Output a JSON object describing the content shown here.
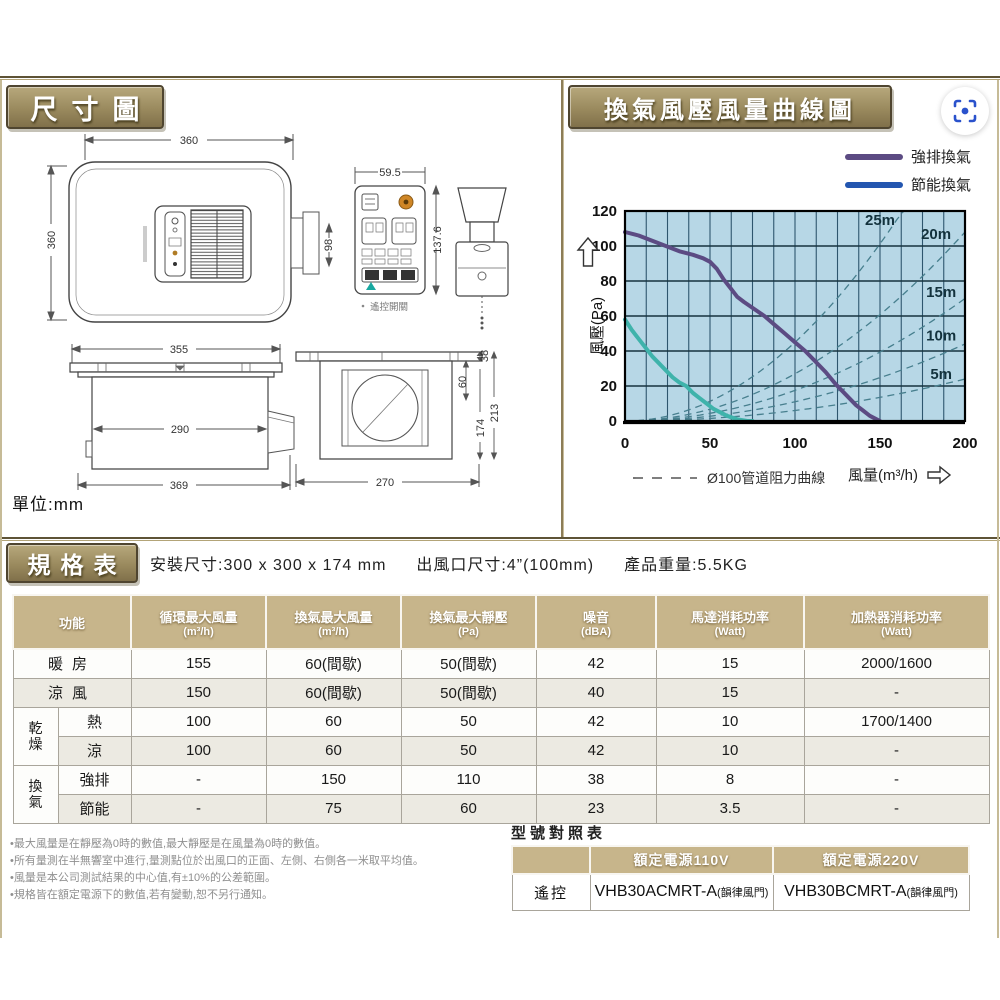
{
  "sections": {
    "dimensions_title": "尺寸圖",
    "curve_title": "換氣風壓風量曲線圖",
    "spec_title": "規格表",
    "unit_label": "單位:mm"
  },
  "dims": {
    "top_view": {
      "w": "360",
      "h": "360",
      "duct": "98"
    },
    "remote": {
      "w": "59.5",
      "h": "137.6",
      "caption": "遙控開關"
    },
    "side_a": {
      "top": "355",
      "inner": "290",
      "bottom": "369"
    },
    "side_b": {
      "flange": "38",
      "neck": "60",
      "total": "213",
      "body": "174",
      "bottom": "270"
    }
  },
  "chart_data": {
    "type": "line",
    "title": "換氣風壓風量曲線圖",
    "xlabel": "風量(m³/h)",
    "ylabel": "風壓(Pa)",
    "xlim": [
      0,
      200
    ],
    "ylim": [
      0,
      120
    ],
    "xticks": [
      0,
      50,
      100,
      150,
      200
    ],
    "yticks": [
      0,
      20,
      40,
      60,
      80,
      100,
      120
    ],
    "grid": {
      "x_step": 12.5,
      "y_step": 20,
      "on": true
    },
    "plot_bg": "#b7d7e6",
    "legend_position": "top-right",
    "series": [
      {
        "name": "強排換氣",
        "color": "#5c4b83",
        "points": [
          [
            0,
            108
          ],
          [
            8,
            106
          ],
          [
            16,
            103
          ],
          [
            24,
            100
          ],
          [
            32,
            97
          ],
          [
            40,
            95
          ],
          [
            46,
            93
          ],
          [
            50,
            91
          ],
          [
            54,
            87
          ],
          [
            58,
            81
          ],
          [
            62,
            76
          ],
          [
            66,
            71
          ],
          [
            70,
            68
          ],
          [
            76,
            64
          ],
          [
            82,
            60
          ],
          [
            88,
            55
          ],
          [
            94,
            50
          ],
          [
            100,
            45
          ],
          [
            106,
            40
          ],
          [
            112,
            34
          ],
          [
            118,
            28
          ],
          [
            124,
            21
          ],
          [
            128,
            17
          ],
          [
            132,
            13
          ],
          [
            136,
            9
          ],
          [
            140,
            6
          ],
          [
            144,
            3
          ],
          [
            148,
            1
          ],
          [
            150,
            0
          ]
        ]
      },
      {
        "name": "節能換氣",
        "color": "#3fb3ab",
        "points": [
          [
            0,
            58
          ],
          [
            4,
            52
          ],
          [
            8,
            47
          ],
          [
            12,
            42
          ],
          [
            16,
            37
          ],
          [
            20,
            33
          ],
          [
            24,
            29
          ],
          [
            28,
            25
          ],
          [
            32,
            22
          ],
          [
            36,
            20
          ],
          [
            40,
            16
          ],
          [
            44,
            13
          ],
          [
            48,
            10
          ],
          [
            52,
            7
          ],
          [
            56,
            5
          ],
          [
            60,
            3
          ],
          [
            66,
            1
          ],
          [
            72,
            0
          ],
          [
            75,
            0
          ]
        ]
      }
    ],
    "legend": [
      {
        "label": "強排換氣",
        "color": "#5c4b83"
      },
      {
        "label": "節能換氣",
        "color": "#2356b0"
      }
    ],
    "resistance_curves": {
      "legend_label": "Ø100管道阻力曲線",
      "color": "#477f8e",
      "curves": [
        {
          "label": "5m",
          "k": 0.0006,
          "label_pos": [
            186,
            24
          ]
        },
        {
          "label": "10m",
          "k": 0.0011,
          "label_pos": [
            186,
            46
          ]
        },
        {
          "label": "15m",
          "k": 0.00175,
          "label_pos": [
            186,
            71
          ]
        },
        {
          "label": "20m",
          "k": 0.0027,
          "label_pos": [
            183,
            104
          ]
        },
        {
          "label": "25m",
          "k": 0.0045,
          "label_pos": [
            150,
            112
          ]
        }
      ]
    }
  },
  "spec_header": {
    "install": "安裝尺寸:300 x 300 x 174 mm",
    "outlet": "出風口尺寸:4”(100mm)",
    "weight": "產品重量:5.5KG"
  },
  "spec_table": {
    "columns": [
      {
        "label": "功能",
        "sub": ""
      },
      {
        "label": "循環最大風量",
        "sub": "(m³/h)"
      },
      {
        "label": "換氣最大風量",
        "sub": "(m³/h)"
      },
      {
        "label": "換氣最大靜壓",
        "sub": "(Pa)"
      },
      {
        "label": "噪音",
        "sub": "(dBA)"
      },
      {
        "label": "馬達消耗功率",
        "sub": "(Watt)"
      },
      {
        "label": "加熱器消耗功率",
        "sub": "(Watt)"
      }
    ],
    "rows": [
      {
        "function": "暖房",
        "span": 2,
        "values": [
          "155",
          "60(間歇)",
          "50(間歇)",
          "42",
          "15",
          "2000/1600"
        ]
      },
      {
        "function": "涼風",
        "span": 2,
        "values": [
          "150",
          "60(間歇)",
          "50(間歇)",
          "40",
          "15",
          "-"
        ]
      },
      {
        "group": "乾燥",
        "function": "熱",
        "values": [
          "100",
          "60",
          "50",
          "42",
          "10",
          "1700/1400"
        ]
      },
      {
        "function": "涼",
        "values": [
          "100",
          "60",
          "50",
          "42",
          "10",
          "-"
        ]
      },
      {
        "group": "換氣",
        "function": "強排",
        "values": [
          "-",
          "150",
          "110",
          "38",
          "8",
          "-"
        ]
      },
      {
        "function": "節能",
        "values": [
          "-",
          "75",
          "60",
          "23",
          "3.5",
          "-"
        ]
      }
    ]
  },
  "footnotes": [
    "•最大風量是在靜壓為0時的數值,最大靜壓是在風量為0時的數值。",
    "•所有量測在半無響室中進行,量測點位於出風口的正面、左側、右側各一米取平均值。",
    "•風量是本公司測試結果的中心值,有±10%的公差範圍。",
    "•規格皆在額定電源下的數值,若有變動,恕不另行通知。"
  ],
  "model_table": {
    "title": "型號對照表",
    "columns": [
      "額定電源110V",
      "額定電源220V"
    ],
    "row_label": "遙控",
    "models": [
      {
        "code": "VHB30ACMRT-A",
        "suffix": "(韻律風門)"
      },
      {
        "code": "VHB30BCMRT-A",
        "suffix": "(韻律風門)"
      }
    ]
  },
  "colors": {
    "ribbon": "#9a8a5e",
    "table_header": "#c7b58b",
    "chart_bg": "#b7d7e6",
    "lens_icon": "#2a52cc"
  }
}
